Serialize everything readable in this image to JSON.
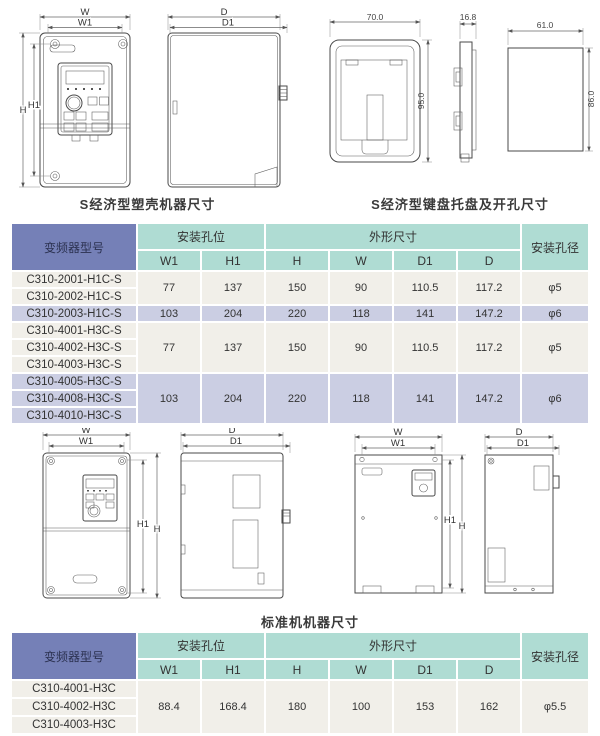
{
  "captions": {
    "s_machine": "S经济型塑壳机器尺寸",
    "s_keypad": "S经济型键盘托盘及开孔尺寸",
    "standard_machine": "标准机机器尺寸"
  },
  "dims": {
    "w": "W",
    "w1": "W1",
    "h": "H",
    "h1": "H1",
    "d": "D",
    "d1": "D1"
  },
  "keypad_dims": {
    "width": "70.0",
    "thickness": "16.8",
    "height": "95.0",
    "hole_width": "61.0",
    "hole_height": "86.0"
  },
  "colors": {
    "header_blue": "#7580B7",
    "header_teal": "#AFDCD3",
    "row_light": "#F1EFE9",
    "row_lavender": "#CBCEE3"
  },
  "table1": {
    "header": {
      "model": "变频器型号",
      "mount": "安装孔位",
      "outline": "外形尺寸",
      "hole": "安装孔径",
      "sub": {
        "w1": "W1",
        "h1": "H1",
        "h": "H",
        "w": "W",
        "d1": "D1",
        "d": "D"
      }
    },
    "groups": [
      {
        "models": [
          "C310-2001-H1C-S",
          "C310-2002-H1C-S"
        ],
        "w1": "77",
        "h1": "137",
        "h": "150",
        "w": "90",
        "d1": "110.5",
        "d": "117.2",
        "hole": "φ5"
      },
      {
        "models": [
          "C310-2003-H1C-S"
        ],
        "w1": "103",
        "h1": "204",
        "h": "220",
        "w": "118",
        "d1": "141",
        "d": "147.2",
        "hole": "φ6"
      },
      {
        "models": [
          "C310-4001-H3C-S",
          "C310-4002-H3C-S",
          "C310-4003-H3C-S"
        ],
        "w1": "77",
        "h1": "137",
        "h": "150",
        "w": "90",
        "d1": "110.5",
        "d": "117.2",
        "hole": "φ5"
      },
      {
        "models": [
          "C310-4005-H3C-S",
          "C310-4008-H3C-S",
          "C310-4010-H3C-S"
        ],
        "w1": "103",
        "h1": "204",
        "h": "220",
        "w": "118",
        "d1": "141",
        "d": "147.2",
        "hole": "φ6"
      }
    ]
  },
  "table2": {
    "header": {
      "model": "变频器型号",
      "mount": "安装孔位",
      "outline": "外形尺寸",
      "hole": "安装孔径",
      "sub": {
        "w1": "W1",
        "h1": "H1",
        "h": "H",
        "w": "W",
        "d1": "D1",
        "d": "D"
      }
    },
    "groups": [
      {
        "models": [
          "C310-4001-H3C",
          "C310-4002-H3C",
          "C310-4003-H3C"
        ],
        "w1": "88.4",
        "h1": "168.4",
        "h": "180",
        "w": "100",
        "d1": "153",
        "d": "162",
        "hole": "φ5.5"
      }
    ]
  }
}
